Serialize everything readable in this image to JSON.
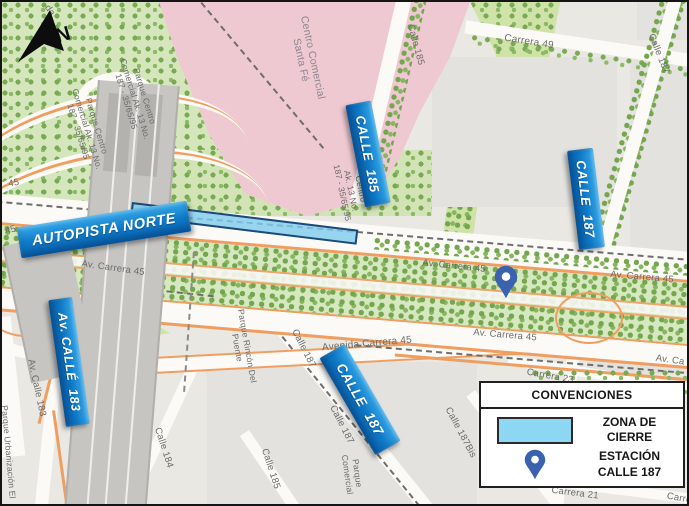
{
  "north_arrow": {
    "label": "N"
  },
  "callouts": [
    {
      "id": "autopista-norte",
      "text": "AUTOPISTA NORTE"
    },
    {
      "id": "calle-185",
      "text": "CALLE  185"
    },
    {
      "id": "calle-187-north",
      "text": "CALLE  187"
    },
    {
      "id": "av-calle-183",
      "text": "Av. CALLÉ  183"
    },
    {
      "id": "calle-187-south",
      "text": "CALLE  187"
    }
  ],
  "street_labels": [
    {
      "text": "Calle 185"
    },
    {
      "text": "Carrera 49"
    },
    {
      "text": "Calle 187"
    },
    {
      "text": "Parque Centro\nComercial Ak. 13 No.\n187 - 35/65/95"
    },
    {
      "text": "Parque Centro\nComercial Ak. 13 No.\n187 - 35/65/95"
    },
    {
      "text": "Centro Comercial\nSanta Fé"
    },
    {
      "text": "45"
    },
    {
      "text": "45"
    },
    {
      "text": "Centro\nAk. 13 No.\n187 - 35/65/95"
    },
    {
      "text": "Av. Carrera 45"
    },
    {
      "text": "Av. Carrera 45"
    },
    {
      "text": "Av. Carrera 45"
    },
    {
      "text": "Av. Carrera 45"
    },
    {
      "text": "Av. Ca"
    },
    {
      "text": "Avenida Carrera 45"
    },
    {
      "text": "Calle 187"
    },
    {
      "text": "Calle 187"
    },
    {
      "text": "Calle 185"
    },
    {
      "text": "Calle 184"
    },
    {
      "text": "Av. Calle 183"
    },
    {
      "text": "Parque Rincón Del\nPuente"
    },
    {
      "text": "Calle 187Bis"
    },
    {
      "text": "Carrera 23"
    },
    {
      "text": "Carrera 21"
    },
    {
      "text": "Carre"
    },
    {
      "text": "Parque\nComercial"
    },
    {
      "text": "Parque Urbanización El"
    },
    {
      "text": "da"
    }
  ],
  "legend": {
    "title": "CONVENCIONES",
    "items": [
      {
        "icon": "closure-zone-swatch",
        "label": "ZONA DE\nCIERRE"
      },
      {
        "icon": "station-pin-icon",
        "label": "ESTACIÓN\nCALLE 187"
      }
    ]
  },
  "colors": {
    "callout_blue": "#0f7ac7",
    "closure_fill": "#8ed7f2",
    "closure_border": "#1a4a75",
    "station_pin_blue": "#3a62ae",
    "road_orange": "#ef9e60",
    "median_green": "#d6e8bf",
    "park_green": "#cfe3a8",
    "mall_pink": "#efc9d2",
    "highway_gray": "#c6c5c2"
  }
}
